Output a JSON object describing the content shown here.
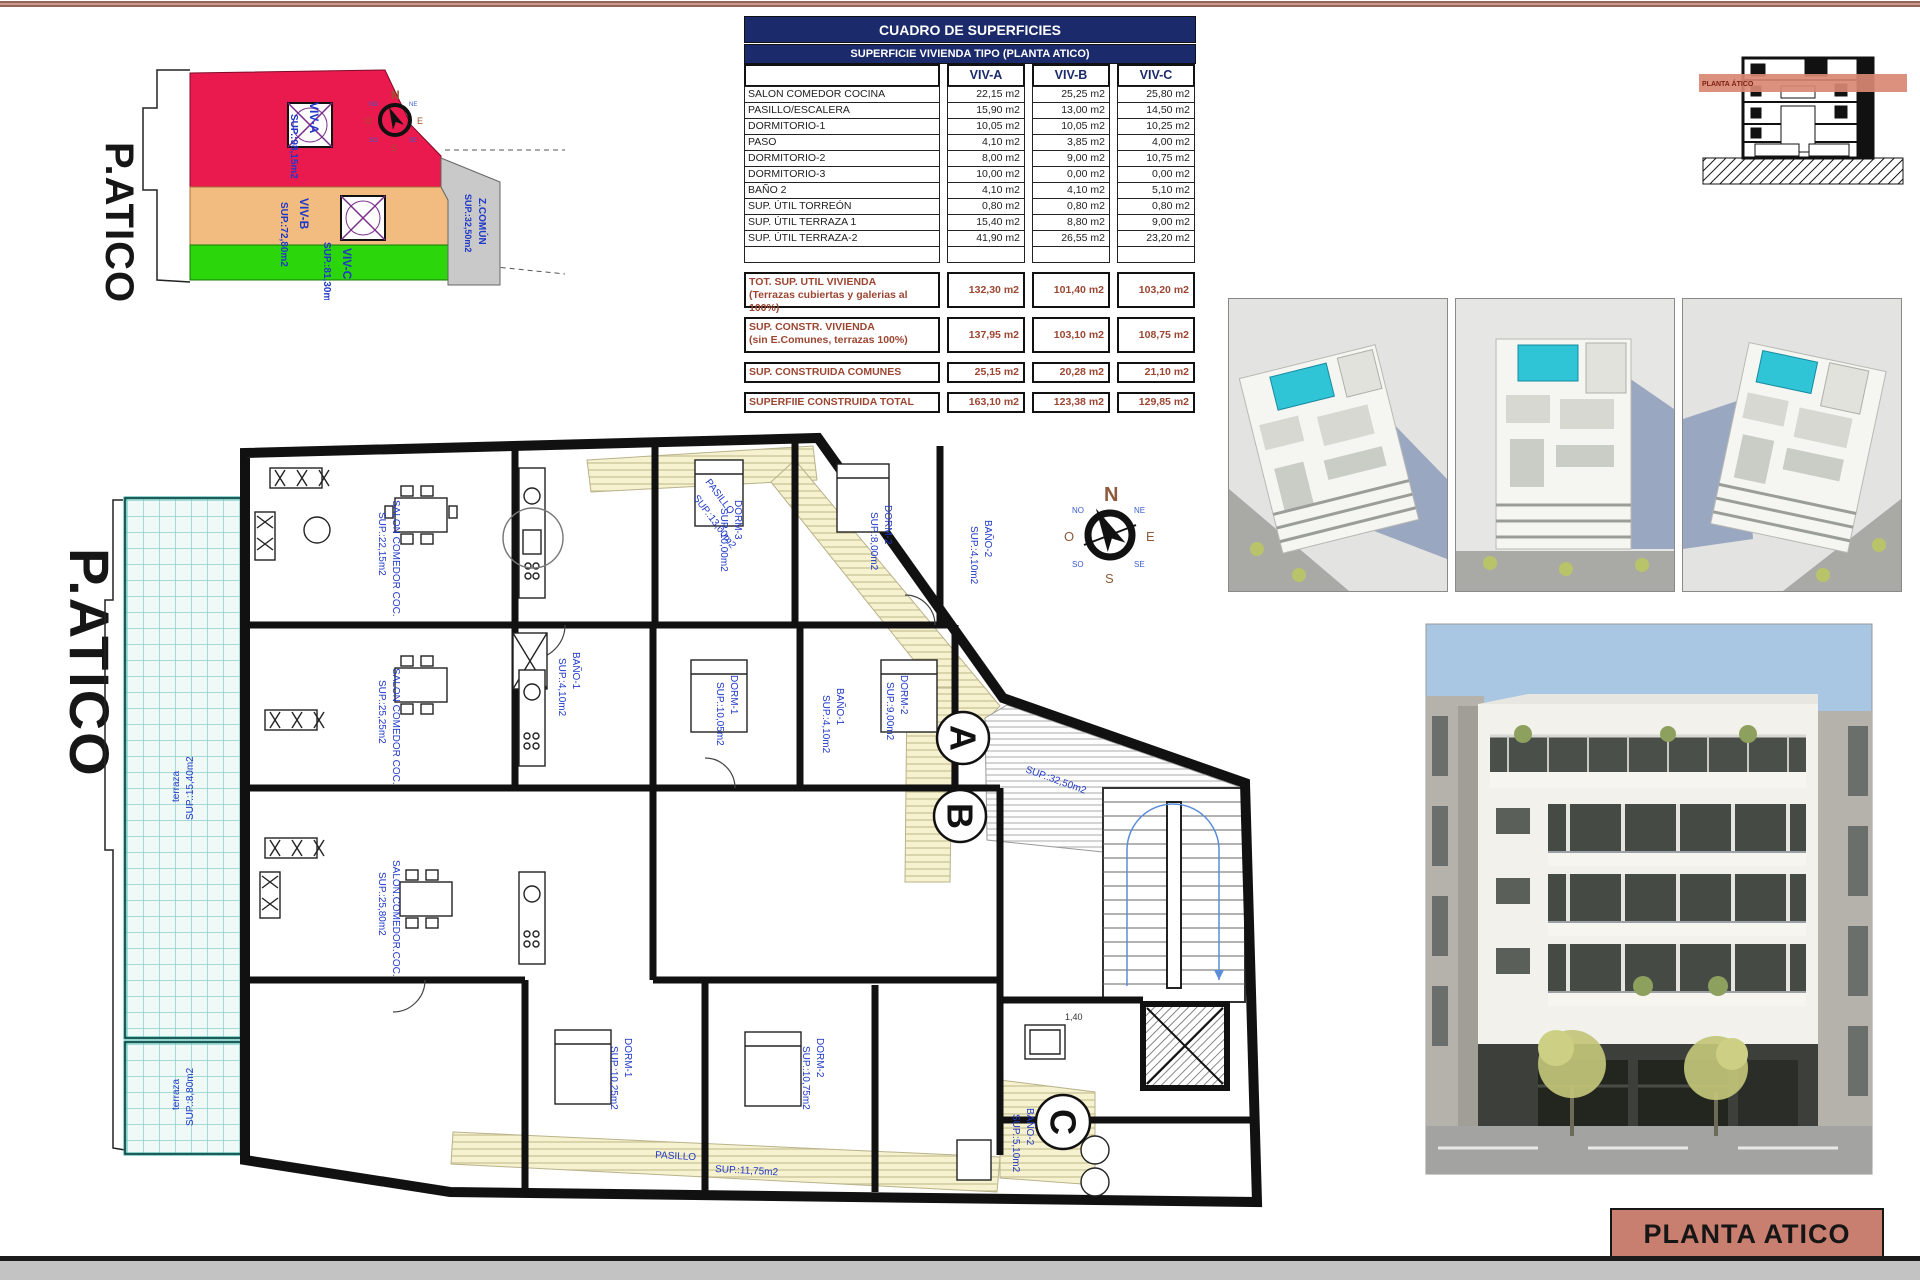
{
  "page": {
    "title_block": "PLANTA ATICO",
    "accent_color": "#c97f6f",
    "header_navy": "#1b2a6b",
    "summary_brown": "#9c4632"
  },
  "table": {
    "title": "CUADRO DE SUPERFICIES",
    "subtitle": "SUPERFICIE VIVIENDA TIPO  (PLANTA ATICO)",
    "columns": [
      "VIV-A",
      "VIV-B",
      "VIV-C"
    ],
    "rows": [
      {
        "label": "SALON COMEDOR COCINA",
        "a": "22,15 m2",
        "b": "25,25 m2",
        "c": "25,80 m2"
      },
      {
        "label": "PASILLO/ESCALERA",
        "a": "15,90 m2",
        "b": "13,00 m2",
        "c": "14,50 m2"
      },
      {
        "label": "DORMITORIO-1",
        "a": "10,05 m2",
        "b": "10,05 m2",
        "c": "10,25 m2"
      },
      {
        "label": "PASO",
        "a": "4,10 m2",
        "b": "3,85 m2",
        "c": "4,00 m2"
      },
      {
        "label": "DORMITORIO-2",
        "a": "8,00 m2",
        "b": "9,00 m2",
        "c": "10,75 m2"
      },
      {
        "label": "DORMITORIO-3",
        "a": "10,00 m2",
        "b": "0,00 m2",
        "c": "0,00 m2"
      },
      {
        "label": "BAÑO 2",
        "a": "4,10 m2",
        "b": "4,10 m2",
        "c": "5,10 m2"
      },
      {
        "label": "SUP. ÚTIL TORREÓN",
        "a": "0,80 m2",
        "b": "0,80 m2",
        "c": "0,80 m2"
      },
      {
        "label": "SUP. ÚTIL TERRAZA 1",
        "a": "15,40 m2",
        "b": "8,80 m2",
        "c": "9,00 m2"
      },
      {
        "label": "SUP. ÚTIL TERRAZA-2",
        "a": "41,90 m2",
        "b": "26,55 m2",
        "c": "23,20 m2"
      }
    ],
    "summary_rows": [
      {
        "label": "TOT. SUP. UTIL VIVIENDA",
        "sublabel": "(Terrazas cubiertas y galerias al 100%)",
        "a": "132,30 m2",
        "b": "101,40 m2",
        "c": "103,20 m2"
      },
      {
        "label": "SUP. CONSTR. VIVIENDA",
        "sublabel": "(sin E.Comunes, terrazas 100%)",
        "a": "137,95 m2",
        "b": "103,10 m2",
        "c": "108,75 m2"
      },
      {
        "label": "SUP. CONSTRUIDA COMUNES",
        "sublabel": "",
        "a": "25,15 m2",
        "b": "20,28 m2",
        "c": "21,10 m2"
      }
    ],
    "total_row": {
      "label": "SUPERFIIE CONSTRUIDA TOTAL",
      "a": "163,10 m2",
      "b": "123,38 m2",
      "c": "129,85 m2"
    }
  },
  "site_diagram": {
    "title": "P.ATICO",
    "zones": [
      {
        "name": "VIV-A",
        "area": "SUP.:98,15m2",
        "color": "#ea1a4e"
      },
      {
        "name": "VIV-B",
        "area": "SUP.:72,80m2",
        "color": "#f2bc80"
      },
      {
        "name": "VIV-C",
        "area": "SUP.:81,30m2",
        "color": "#2bd60b"
      },
      {
        "name": "Z.COMÚN",
        "area": "SUP.:32,50m2",
        "color": "#c9c9c9"
      }
    ]
  },
  "section_sketch": {
    "band_label": "PLANTA ÁTICO"
  },
  "floor_plan": {
    "title": "P.ATICO",
    "units": {
      "a": "A",
      "b": "B",
      "c": "C"
    },
    "labels": [
      "terraza",
      "SUP.:15,40m2",
      "terraza",
      "SUP.:8,80m2",
      "PASILLO",
      "SUP.:13,00m2",
      "SALON COMEDOR COC.",
      "SUP.:22,15m2",
      "DORM-3",
      "SUP.:10,00m2",
      "DORM-2",
      "SUP.:8,00m2",
      "BAÑO-2",
      "SUP.:4,10m2",
      "SALON COMEDOR COC.",
      "SUP.:25,25m2",
      "DORM-1",
      "SUP.:10,05m2",
      "DORM-2",
      "SUP.:9,00m2",
      "SALON.COMEDOR.COC.",
      "SUP.:25,80m2",
      "DORM-1",
      "SUP.:10,25m2",
      "DORM-2",
      "SUP.:10,75m2",
      "SUP.:32,50m2",
      "PASILLO",
      "SUP.:11,75m2",
      "BAÑO-2",
      "SUP.:5,10m2",
      "1,40",
      "BAÑO-1",
      "SUP.:4,10m2",
      "BAÑO-1",
      "SUP.:4,10m2"
    ]
  },
  "compass": {
    "n": "N",
    "s": "S",
    "e": "E",
    "o": "O",
    "ne": "NE",
    "no": "NO",
    "se": "SE",
    "so": "SO"
  }
}
